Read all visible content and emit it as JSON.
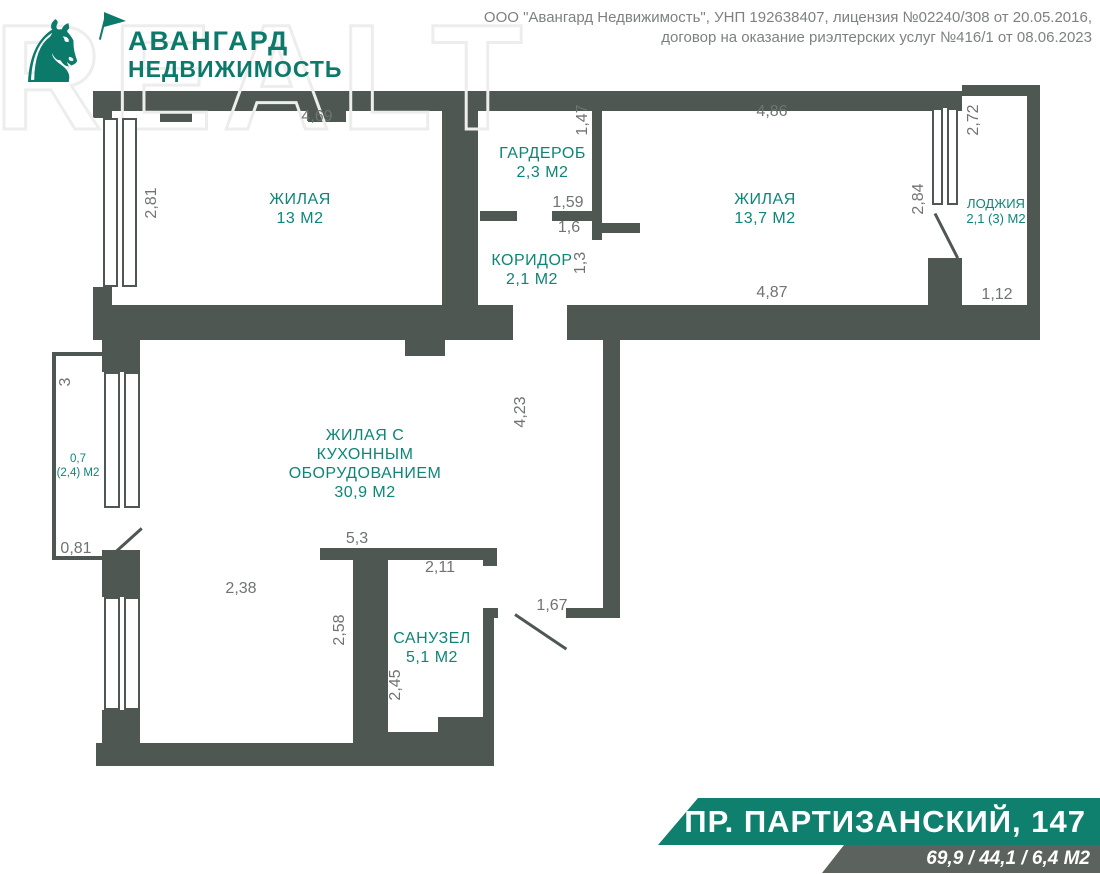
{
  "header": {
    "watermark": "REALT",
    "logo": {
      "icon": "knight-horse-icon",
      "line1": "АВАНГАРД",
      "line2": "НЕДВИЖИМОСТЬ"
    },
    "company_info": "ООО \"Авангард Недвижимость\", УНП 192638407, лицензия №02240/308 от 20.05.2016,\nдоговор на оказание риэлтерских услуг №416/1 от 08.06.2023"
  },
  "floorplan": {
    "rooms": [
      {
        "name": "ЖИЛАЯ",
        "area": "13 М2"
      },
      {
        "name": "ГАРДЕРОБ",
        "area": "2,3 М2"
      },
      {
        "name": "ЖИЛАЯ",
        "area": "13,7 М2"
      },
      {
        "name": "ЛОДЖИЯ",
        "area": "2,1 (3) М2"
      },
      {
        "name": "КОРИДОР",
        "area": "2,1 М2"
      },
      {
        "name": "ЖИЛАЯ С\nКУХОННЫМ\nОБОРУДОВАНИЕМ",
        "area": "30,9 М2"
      },
      {
        "name": "САНУЗЕЛ",
        "area": "5,1 М2"
      },
      {
        "name": "0,7",
        "area": "(2,4) М2"
      }
    ],
    "dims": {
      "room13_top": "4,69",
      "room13_left": "2,81",
      "garderob_right": "1,47",
      "room137_top": "4,86",
      "room137_right": "2,84",
      "room137_bottom": "4,87",
      "loggia_top": "2,72",
      "loggia_bottom": "1,12",
      "garderob_door": "1,59",
      "koridor_width": "1,6",
      "koridor_height": "1,3",
      "bigroom_right": "4,23",
      "bigroom_left": "2,38",
      "bigroom_wall": "5,3",
      "balcony_side": "3",
      "balcony_bottom": "0,81",
      "sanuzel_top": "2,11",
      "sanuzel_left": "2,58",
      "sanuzel_inner": "2,45",
      "entrance": "1,67"
    }
  },
  "footer": {
    "address": "ПР. ПАРТИЗАНСКИЙ, 147",
    "areas": "69,9 / 44,1 / 6,4 М2"
  },
  "colors": {
    "wall": "#4e5751",
    "room_label": "#0e8577",
    "dimension_text": "#6f7471",
    "logo_teal": "#0c7a6b",
    "banner_teal": "#0f7f6e",
    "banner_gray": "#5c635f"
  }
}
